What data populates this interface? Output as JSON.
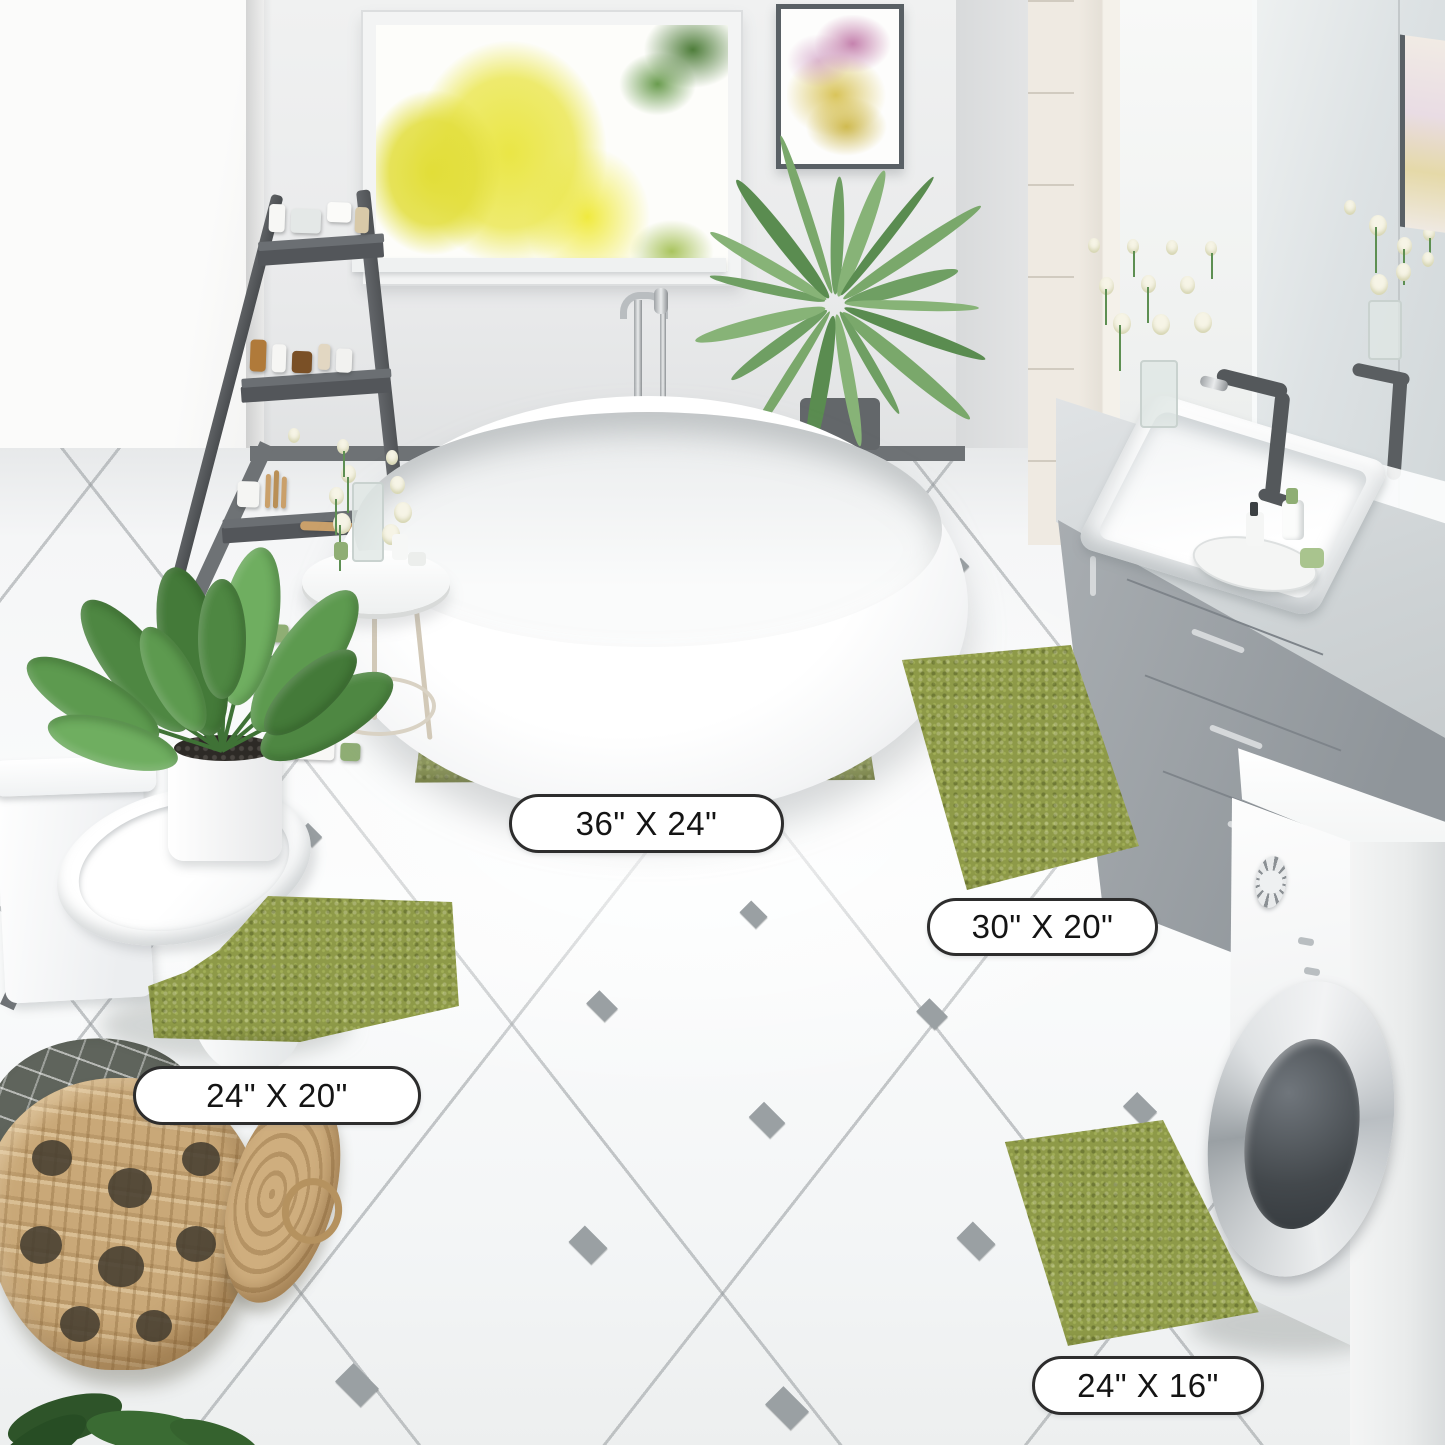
{
  "product_labels": {
    "mat_large": "36\" X 24\"",
    "mat_runner": "30\" X 20\"",
    "mat_contour": "24\" X 20\"",
    "mat_small": "24\" X 16\""
  },
  "colors": {
    "mat_green": "#8e9a48",
    "mat_green_dark": "#6f7a33",
    "mat_green_light": "#a8b45e",
    "wall": "#e7e8e9",
    "wall_left": "#f6f6f5",
    "floor": "#f4f5f6",
    "tile_line": "#a9adb0",
    "tile_diamond": "#9aa0a3",
    "baseboard": "#6e7275",
    "ladder": "#56595c",
    "vanity_cabinet": "#9aa0a4",
    "vanity_counter": "#d3d7d9",
    "faucet_dark": "#54585b",
    "label_border": "#2d2d2d",
    "label_text": "#141414",
    "basket_tan": "#c9a878",
    "plant_green": "#57904a",
    "tree_yellow": "#e8e23f",
    "towel_gray": "#5f645c"
  }
}
